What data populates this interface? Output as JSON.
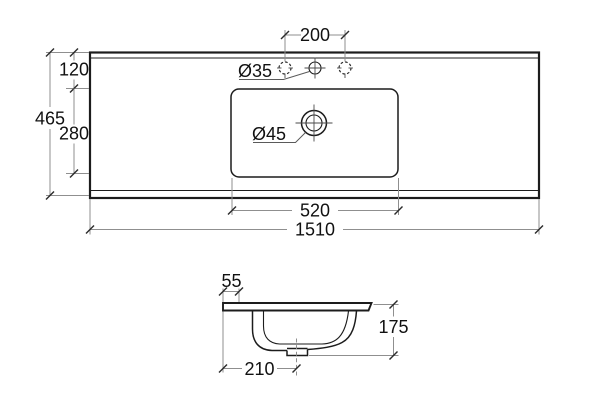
{
  "diagram": {
    "colors": {
      "background": "#ffffff",
      "line": "#1c1c1c",
      "dim": "#8f8f8f"
    },
    "top_view": {
      "dims": {
        "tap_hole_spacing": "200",
        "tap_hole_diameter": "Ø35",
        "drain_diameter": "Ø45",
        "back_edge_to_basin": "120",
        "overall_depth": "465",
        "basin_depth": "280",
        "basin_width": "520",
        "overall_width": "1510"
      }
    },
    "side_view": {
      "dims": {
        "back_to_tap_center": "55",
        "overall_height": "175",
        "back_to_drain_center": "210"
      }
    }
  }
}
